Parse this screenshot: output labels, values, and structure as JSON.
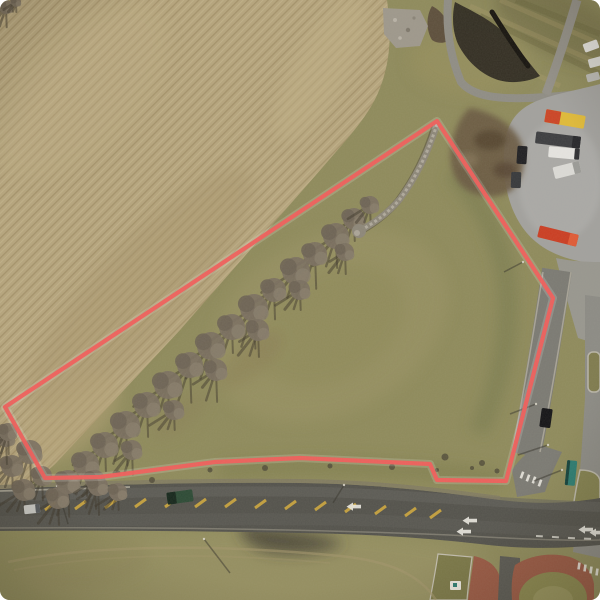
{
  "scene": {
    "type": "aerial-drone-photo",
    "subject": "vacant land parcel outlined in red between a plowed field, a tree line, a commercial truck lot and a rural highway intersection",
    "canvas": {
      "w": 600,
      "h": 600
    }
  },
  "palette": {
    "grass_base": "#8f8b5c",
    "field_tan": "#b6a57d",
    "road_asphalt": "#53524c",
    "parking_grey": "#a2a19e",
    "parcel_line": "#f15e5b",
    "parcel_halo": "#ffffff",
    "yellow_paint": "#c9a43e",
    "white_paint": "#e9e7df",
    "tree_canopy": "#7b7061",
    "tree_canopy2": "#6d6354",
    "tree_canopy3": "#877c6b",
    "tree_shadow": "#3f382c",
    "shadow_line": "#35322a",
    "stripe_light": "#a89a6b",
    "stripe_dark": "#6b673f",
    "bush": "#4f4a38",
    "pond_dark": "#2e2a21",
    "brick_apron": "#9a5a45",
    "stone_wall": "#8d8779"
  },
  "parcel": {
    "points": "437,121 553,298 506,481 437,480 430,464 300,458 215,462 100,477 45,478 5,407",
    "line_width": 4.2,
    "halo_width": 8
  },
  "stone_wall": {
    "path": "M437,124 C429,150 417,176 400,199 C390,211 377,221 363,229"
  },
  "trees": [
    [
      354,
      219,
      11
    ],
    [
      336,
      236,
      13
    ],
    [
      315,
      254,
      12
    ],
    [
      296,
      271,
      14
    ],
    [
      274,
      290,
      12
    ],
    [
      254,
      308,
      14
    ],
    [
      232,
      327,
      13
    ],
    [
      211,
      346,
      14
    ],
    [
      190,
      365,
      13
    ],
    [
      168,
      385,
      14
    ],
    [
      147,
      405,
      13
    ],
    [
      126,
      425,
      14
    ],
    [
      105,
      445,
      13
    ],
    [
      86,
      464,
      13
    ],
    [
      68,
      482,
      12
    ],
    [
      300,
      290,
      10
    ],
    [
      258,
      330,
      11
    ],
    [
      216,
      370,
      11
    ],
    [
      174,
      410,
      10
    ],
    [
      132,
      450,
      10
    ],
    [
      95,
      480,
      10
    ],
    [
      370,
      205,
      9
    ],
    [
      345,
      252,
      9
    ],
    [
      30,
      452,
      12
    ],
    [
      12,
      466,
      11
    ],
    [
      42,
      476,
      10
    ],
    [
      6,
      438,
      9
    ],
    [
      24,
      490,
      11
    ],
    [
      58,
      498,
      11
    ],
    [
      98,
      486,
      10
    ],
    [
      118,
      492,
      9
    ],
    [
      8,
      432,
      9
    ],
    [
      6,
      7,
      7
    ],
    [
      16,
      2,
      5
    ]
  ],
  "vehicles": [
    {
      "name": "semi-trailer-yellow-red",
      "x": 565,
      "y": 119,
      "w": 40,
      "h": 13,
      "rot": 10,
      "color": "#e0ba38",
      "accent": "#cc4425",
      "accent_frac": 0.38,
      "accent_side": "left"
    },
    {
      "name": "semi-trailer-dark",
      "x": 558,
      "y": 140,
      "w": 45,
      "h": 12,
      "rot": 7,
      "color": "#3c3d40",
      "accent": "#26262a",
      "accent_frac": 0.18,
      "accent_side": "right"
    },
    {
      "name": "box-truck-white",
      "x": 564,
      "y": 153,
      "w": 31,
      "h": 11,
      "rot": 5,
      "color": "#e6e5e1",
      "accent": "#2e2e31",
      "accent_frac": 0.16,
      "accent_side": "right"
    },
    {
      "name": "van-white",
      "x": 567,
      "y": 170,
      "w": 27,
      "h": 12,
      "rot": -14,
      "color": "#dcdbd7",
      "accent": "#9b9b97",
      "accent_frac": 0.25,
      "accent_side": "right"
    },
    {
      "name": "car-black-lot",
      "x": 522,
      "y": 155,
      "w": 10,
      "h": 18,
      "rot": 4,
      "color": "#1f1f22"
    },
    {
      "name": "car-dark-lot",
      "x": 516,
      "y": 180,
      "w": 10,
      "h": 16,
      "rot": 2,
      "color": "#36383b"
    },
    {
      "name": "semi-trailer-red",
      "x": 558,
      "y": 236,
      "w": 40,
      "h": 12,
      "rot": 14,
      "color": "#cb3d22",
      "accent": "#e05a35",
      "accent_frac": 0.22,
      "accent_side": "right"
    },
    {
      "name": "car-white-ne-1",
      "x": 591,
      "y": 46,
      "w": 15,
      "h": 9,
      "rot": -20,
      "color": "#e2e1dd"
    },
    {
      "name": "car-white-ne-2",
      "x": 596,
      "y": 62,
      "w": 15,
      "h": 9,
      "rot": -15,
      "color": "#d8d7d3"
    },
    {
      "name": "car-grey-ne",
      "x": 593,
      "y": 77,
      "w": 13,
      "h": 8,
      "rot": -15,
      "color": "#b9b8b4"
    },
    {
      "name": "pickup-green",
      "x": 180,
      "y": 497,
      "w": 26,
      "h": 12,
      "rot": -8,
      "color": "#2c4a35",
      "accent": "#16271c",
      "accent_frac": 0.35,
      "accent_side": "left"
    },
    {
      "name": "car-silver",
      "x": 32,
      "y": 509,
      "w": 16,
      "h": 9,
      "rot": -6,
      "color": "#c9c9c5",
      "accent": "#565a5e",
      "accent_frac": 0.28,
      "accent_side": "right"
    },
    {
      "name": "car-black-road",
      "x": 546,
      "y": 418,
      "w": 11,
      "h": 19,
      "rot": 8,
      "color": "#141417"
    },
    {
      "name": "truck-teal",
      "x": 571,
      "y": 473,
      "w": 10,
      "h": 25,
      "rot": 6,
      "color": "#2d7d72",
      "accent": "#14423c",
      "accent_frac": 0.3,
      "accent_side": "left"
    }
  ],
  "yellow_hash_marks": [
    [
      45,
      504
    ],
    [
      75,
      503
    ],
    [
      105,
      502
    ],
    [
      135,
      501
    ],
    [
      165,
      501
    ],
    [
      195,
      501
    ],
    [
      225,
      501
    ],
    [
      255,
      502
    ],
    [
      285,
      503
    ],
    [
      315,
      504
    ],
    [
      345,
      506
    ],
    [
      375,
      508
    ],
    [
      405,
      510
    ],
    [
      430,
      512
    ]
  ],
  "white_arrows": [
    [
      352,
      506
    ],
    [
      468,
      520
    ],
    [
      462,
      531
    ],
    [
      584,
      529
    ],
    [
      595,
      532
    ]
  ],
  "crosswalk_bars": [
    [
      522,
      475,
      20
    ],
    [
      528,
      478,
      20
    ],
    [
      534,
      480,
      20
    ],
    [
      540,
      483,
      20
    ],
    [
      579,
      566,
      8
    ],
    [
      585,
      568,
      8
    ],
    [
      591,
      570,
      8
    ],
    [
      597,
      572,
      8
    ]
  ],
  "pole_shadows": [
    [
      57,
      486,
      68,
      524
    ],
    [
      204,
      539,
      230,
      573
    ],
    [
      344,
      485,
      333,
      503
    ],
    [
      536,
      404,
      510,
      414
    ],
    [
      548,
      445,
      518,
      455
    ],
    [
      562,
      470,
      534,
      481
    ],
    [
      523,
      262,
      504,
      272
    ]
  ],
  "ne_stripes_light": [
    [
      470,
      6,
      600,
      64
    ],
    [
      452,
      34,
      560,
      86
    ],
    [
      500,
      0,
      600,
      44
    ]
  ],
  "ne_stripes_dark": [
    [
      480,
      16,
      600,
      74
    ],
    [
      516,
      0,
      600,
      34
    ]
  ],
  "bushes": [
    [
      265,
      468,
      3
    ],
    [
      330,
      466,
      2.5
    ],
    [
      392,
      467,
      3
    ],
    [
      445,
      457,
      3.5
    ],
    [
      482,
      463,
      3
    ],
    [
      497,
      471,
      2.5
    ],
    [
      210,
      470,
      2.5
    ],
    [
      152,
      480,
      3
    ],
    [
      118,
      473,
      2.5
    ],
    [
      437,
      470,
      2
    ],
    [
      472,
      468,
      2
    ]
  ]
}
